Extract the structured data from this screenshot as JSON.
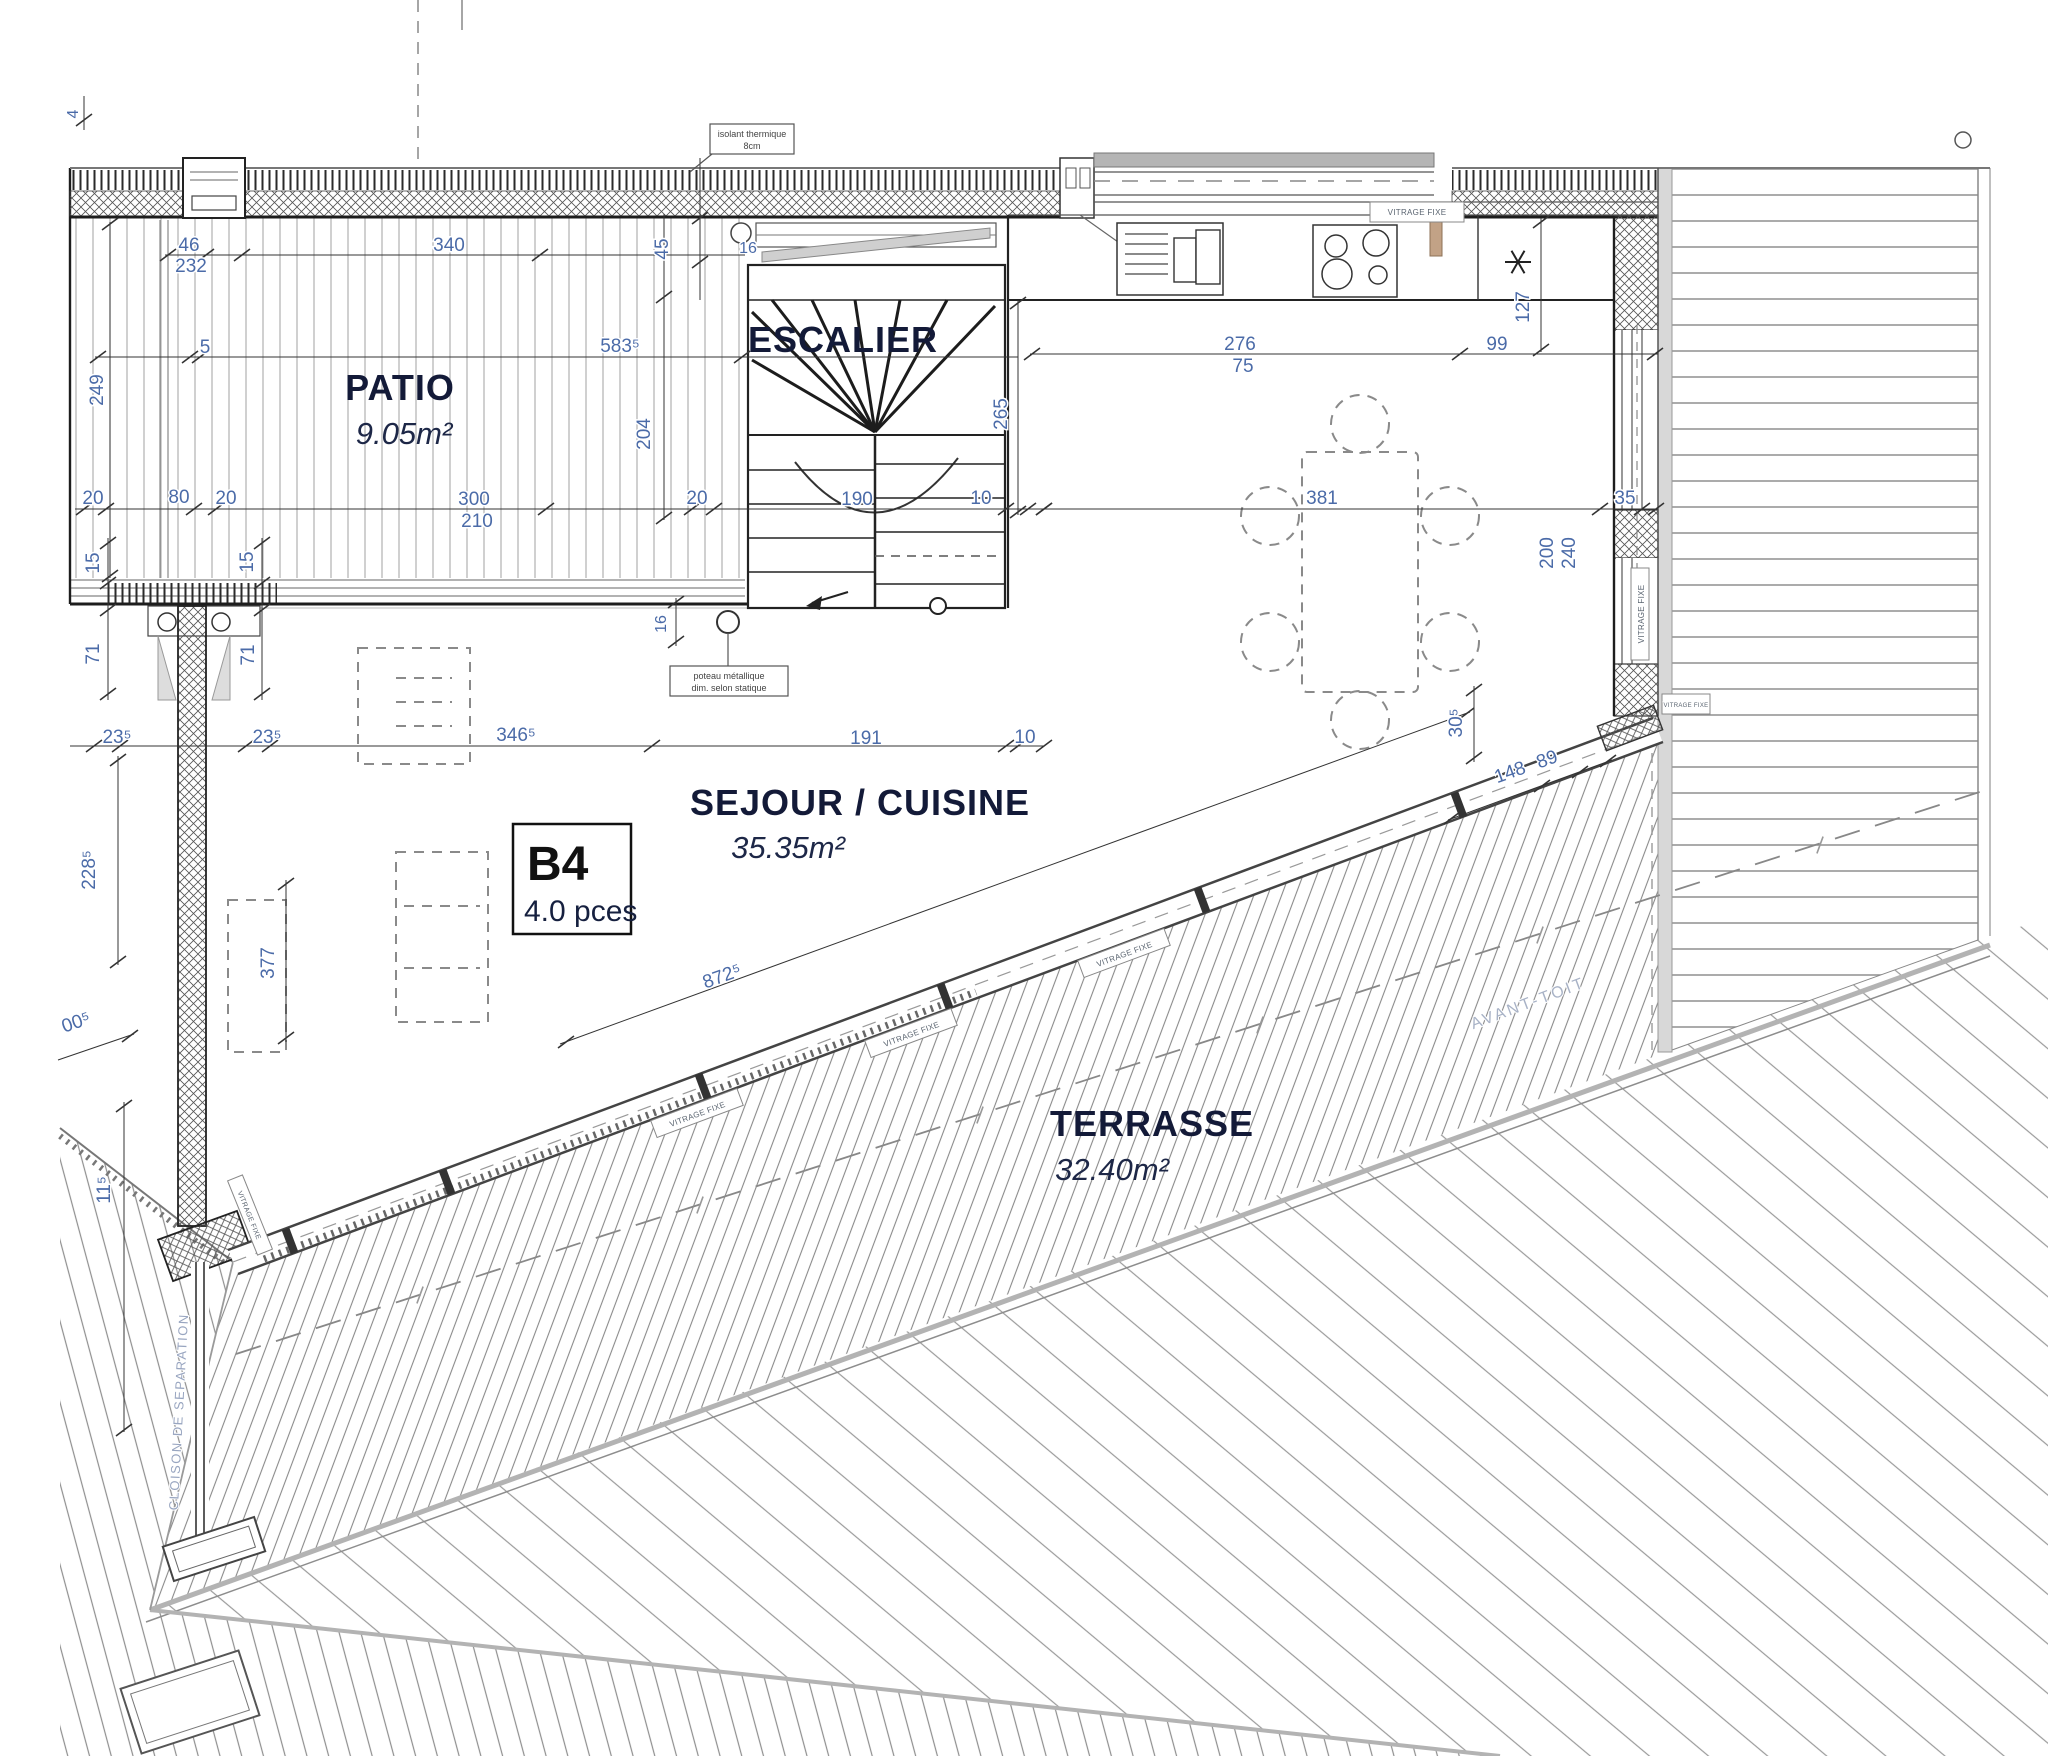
{
  "plan": {
    "unit": {
      "id": "B4",
      "pieces": "4.0 pces"
    },
    "rooms": {
      "patio": {
        "name": "PATIO",
        "area": "9.05m²"
      },
      "escalier": {
        "name": "ESCALIER"
      },
      "sejour": {
        "name": "SEJOUR / CUISINE",
        "area": "35.35m²"
      },
      "terrasse": {
        "name": "TERRASSE",
        "area": "32.40m²"
      }
    },
    "annotations": {
      "avant_toit": "AVANT-TOIT",
      "cloison": "CLOISON DE SEPARATION",
      "poteau_l1": "poteau métallique",
      "poteau_l2": "dim. selon statique",
      "isolant_l1": "isolant thermique",
      "isolant_l2": "8cm",
      "vitrage": "VITRAGE FIXE"
    },
    "dims": {
      "d4": "4",
      "d46": "46",
      "d232": "232",
      "d340": "340",
      "d5": "5",
      "d5835": "583⁵",
      "d249": "249",
      "d45": "45",
      "d204": "204",
      "d16a": "16",
      "d20a": "20",
      "d80": "80",
      "d20b": "20",
      "d300": "300",
      "d210": "210",
      "d20c": "20",
      "d190": "190",
      "d10a": "10",
      "d15a": "15",
      "d15b": "15",
      "d16b": "16",
      "d71a": "71",
      "d71b": "71",
      "d235a": "23⁵",
      "d235b": "23⁵",
      "d3465": "346⁵",
      "d191": "191",
      "d10b": "10",
      "d2285": "228⁵",
      "d377": "377",
      "d005": "00⁵",
      "d115": "11⁵",
      "d8725": "872⁵",
      "d265": "265",
      "d276": "276",
      "d75": "75",
      "d99": "99",
      "d127": "127",
      "d381": "381",
      "d200": "200",
      "d240": "240",
      "d35": "35",
      "d148": "148",
      "d89": "89",
      "d305": "30⁵"
    }
  }
}
